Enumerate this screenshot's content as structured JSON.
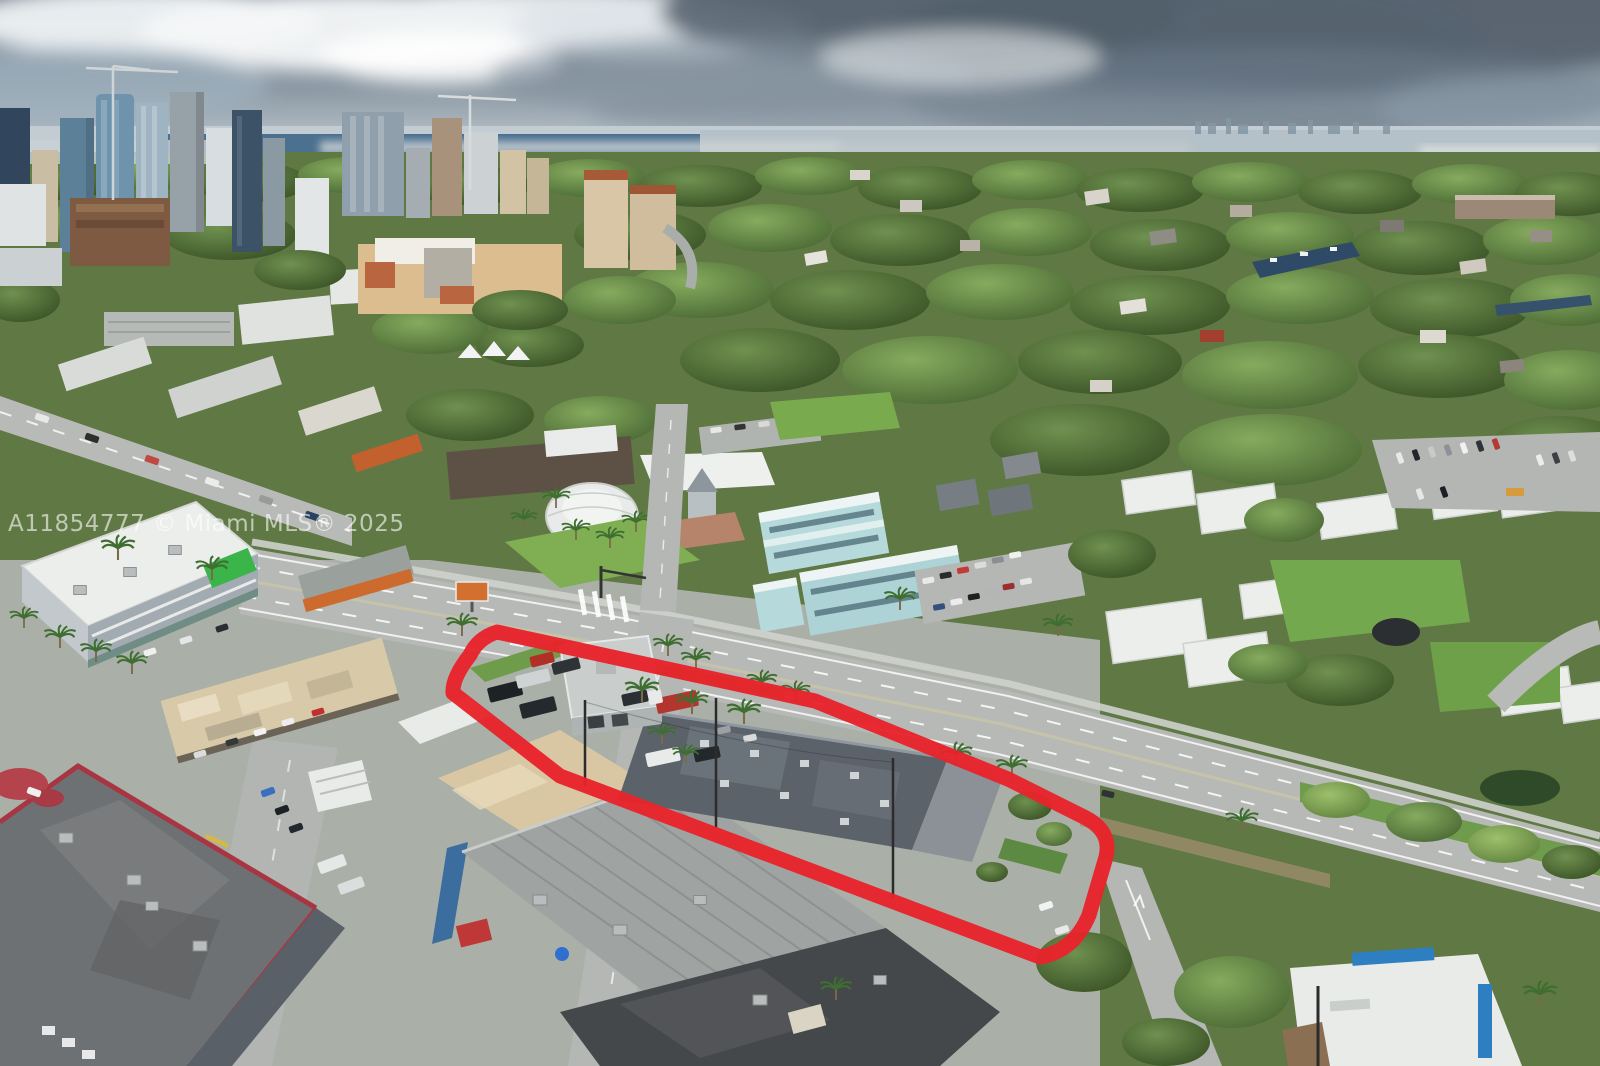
{
  "photo": {
    "kind": "aerial-drone-photo-of-city-with-property-outline",
    "watermark": {
      "text": "A11854777 © Miami MLS® 2025"
    },
    "outline": {
      "color": "#e8232b"
    },
    "palette": {
      "sky_top": "#67737f",
      "sky_horizon": "#c6d0d6",
      "cloud_dark": "#566470",
      "cloud_light": "#eef2f4",
      "ocean": "#466c8c",
      "canopy": "#4e6b38",
      "grass": "#7fae53",
      "road": "#b6b9b5",
      "roof_industrial": "#9fa3a2",
      "roof_dark": "#5c6269",
      "roof_tan": "#d8c9a8",
      "teal_building": "#b6d9dc",
      "white_building": "#eceeec"
    }
  }
}
